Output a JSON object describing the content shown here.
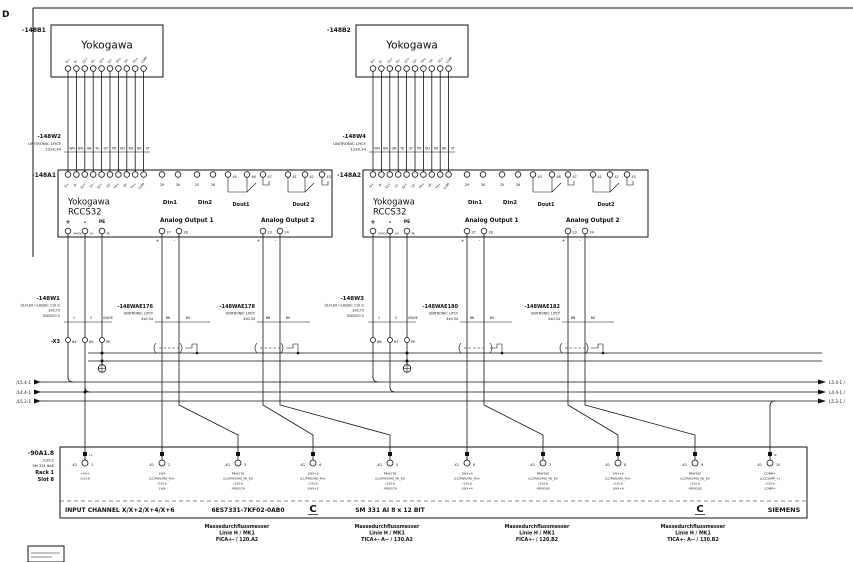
{
  "zone": {
    "row": "D",
    "col": "C"
  },
  "field_devices": {
    "b1": {
      "ref": "-148B1",
      "name": "Yokogawa"
    },
    "b2": {
      "ref": "-148B2",
      "name": "Yokogawa"
    },
    "pins": [
      "D+",
      "D-",
      "S1+",
      "S1-",
      "S2+",
      "S2-",
      "TP+",
      "TP-",
      "TS+",
      "COM"
    ]
  },
  "cables": {
    "w2": {
      "ref": "-148W2",
      "type": "UNITRONIC LIYCY",
      "spec": "12x0,34",
      "cores": [
        "WH",
        "BN",
        "GN",
        "YE",
        "GY",
        "PK",
        "BU",
        "RD",
        "BK",
        "VT"
      ]
    },
    "w4": {
      "ref": "-148W4",
      "type": "UNITRONIC LIYCY",
      "spec": "12x0,34",
      "cores": [
        "WH",
        "BN",
        "GN",
        "YE",
        "GY",
        "PK",
        "BU",
        "RD",
        "BK",
        "VT"
      ]
    },
    "w1": {
      "ref": "-148W1",
      "type": "ÖLFLEX CLASSIC 110 G",
      "spec": "3x0,75",
      "voltage": "300/500 V",
      "cores": [
        "1",
        "2",
        "GN/YE"
      ]
    },
    "w3": {
      "ref": "-148W3",
      "type": "ÖLFLEX CLASSIC 110 G",
      "spec": "3x0,75",
      "voltage": "300/500 V",
      "cores": [
        "1",
        "2",
        "GN/YE"
      ]
    },
    "wae176": {
      "ref": "-148WAE176",
      "type": "UNITRONIC LIYCY",
      "spec": "4x0,34",
      "cores": [
        "BN",
        "BU"
      ]
    },
    "wae178": {
      "ref": "-148WAE178",
      "type": "UNITRONIC LIYCY",
      "spec": "4x0,34",
      "cores": [
        "BN",
        "BU"
      ]
    },
    "wae180": {
      "ref": "-148WAE180",
      "type": "UNITRONIC LIYCY",
      "spec": "4x0,34",
      "cores": [
        "BN",
        "BU"
      ]
    },
    "wae182": {
      "ref": "-148WAE182",
      "type": "UNITRONIC LIYCY",
      "spec": "4x0,34",
      "cores": [
        "BN",
        "BU"
      ]
    }
  },
  "converters": {
    "a1": {
      "ref": "-148A1"
    },
    "a2": {
      "ref": "-148A2"
    },
    "maker": "Yokogawa",
    "model": "RCCS32",
    "labels": {
      "din1": "Din1",
      "din2": "Din2",
      "dout1": "Dout1",
      "dout2": "Dout2",
      "ao1": "Analog Output 1",
      "ao2": "Analog Output 2",
      "plus": "+",
      "minus": "-",
      "pe": "PE",
      "v24": "24VDC",
      "v0": "0V",
      "pe_small": "PE"
    },
    "terms": {
      "din": [
        "29",
        "30",
        "25",
        "26"
      ],
      "dout": [
        "45",
        "46",
        "47",
        "41",
        "42",
        "43"
      ],
      "ao": [
        "27",
        "28",
        "23",
        "24"
      ],
      "ao_pol": [
        "+",
        "-",
        "+",
        "-"
      ]
    }
  },
  "x3": {
    "ref": "-X3",
    "g1": [
      "64",
      "65",
      "PE"
    ],
    "g2": [
      "66",
      "67",
      "PE"
    ]
  },
  "bus": {
    "left": [
      "/L5.4-1",
      "/L4.4-1",
      "/L5.2-1"
    ],
    "right": [
      "L5.4-1 /",
      "L4.4-1 /",
      "L5.2-1 /"
    ]
  },
  "plc": {
    "ref": "-90A1.8",
    "xref": "/120.1",
    "module": "SM 331 8AE",
    "rack": "Rack 1",
    "slot": "Slot 8",
    "strip": "-X1",
    "channels": [
      {
        "n": "1",
        "top": "L+",
        "lines": [
          "+VA+",
          "/133.6"
        ]
      },
      {
        "n": "2",
        "lines": [
          "1WX",
          "(LC/PWS/MO_M)+",
          "/133.6",
          "1WX"
        ]
      },
      {
        "n": "3",
        "lines": [
          "PEW176",
          "(LC/PWS/MO_M)_K0",
          "/133.6",
          "-PEW176"
        ]
      },
      {
        "n": "4",
        "lines": [
          "1WX+2",
          "(LC/PWS/MO_M)+",
          "/133.6",
          "1WX+2"
        ]
      },
      {
        "n": "5",
        "lines": [
          "PEW178",
          "(LC/PWS/MO_M)_K0",
          "/133.6",
          "-PEW178"
        ]
      },
      {
        "n": "6",
        "lines": [
          "1WX+4",
          "(LC/PWS/MO_M)+",
          "/133.6",
          "1WX+4"
        ]
      },
      {
        "n": "7",
        "lines": [
          "PEW180",
          "(LC/PWS/MO_M)_K0",
          "/133.6",
          "-PEW180"
        ]
      },
      {
        "n": "8",
        "lines": [
          "1WX+6",
          "(LC/PWS/MO_M)+",
          "/133.6",
          "1WX+6"
        ]
      },
      {
        "n": "9",
        "lines": [
          "PEW182",
          "(LC/PWS/MO_M)_K0",
          "/133.6",
          "-PEW182"
        ]
      },
      {
        "n": "10",
        "top": "M",
        "lines": [
          "COMP+",
          "(LC/COMP_+)",
          "/133.6",
          "COMP+"
        ]
      }
    ],
    "footer": {
      "input": "INPUT CHANNEL X/X+2/X+4/X+6",
      "order": "6ES7331-7KF02-0AB0",
      "type": "SM 331 AI 8 x 12 BIT",
      "brand": "SIEMENS"
    }
  },
  "captions": [
    {
      "l1": "Massedurchflussmesser",
      "l2": "Linie H / MK1",
      "l3": "FICA+- / 120.A2"
    },
    {
      "l1": "Massedurchflussmesser",
      "l2": "Linie H / MK1",
      "l3": "TICA+- A-- / 130.A2"
    },
    {
      "l1": "Massedurchflussmesser",
      "l2": "Linie H / MK1",
      "l3": "FICA+- / 120.B2"
    },
    {
      "l1": "Massedurchflussmesser",
      "l2": "Linie H / MK1",
      "l3": "TICA+- A-- / 130.B2"
    }
  ]
}
